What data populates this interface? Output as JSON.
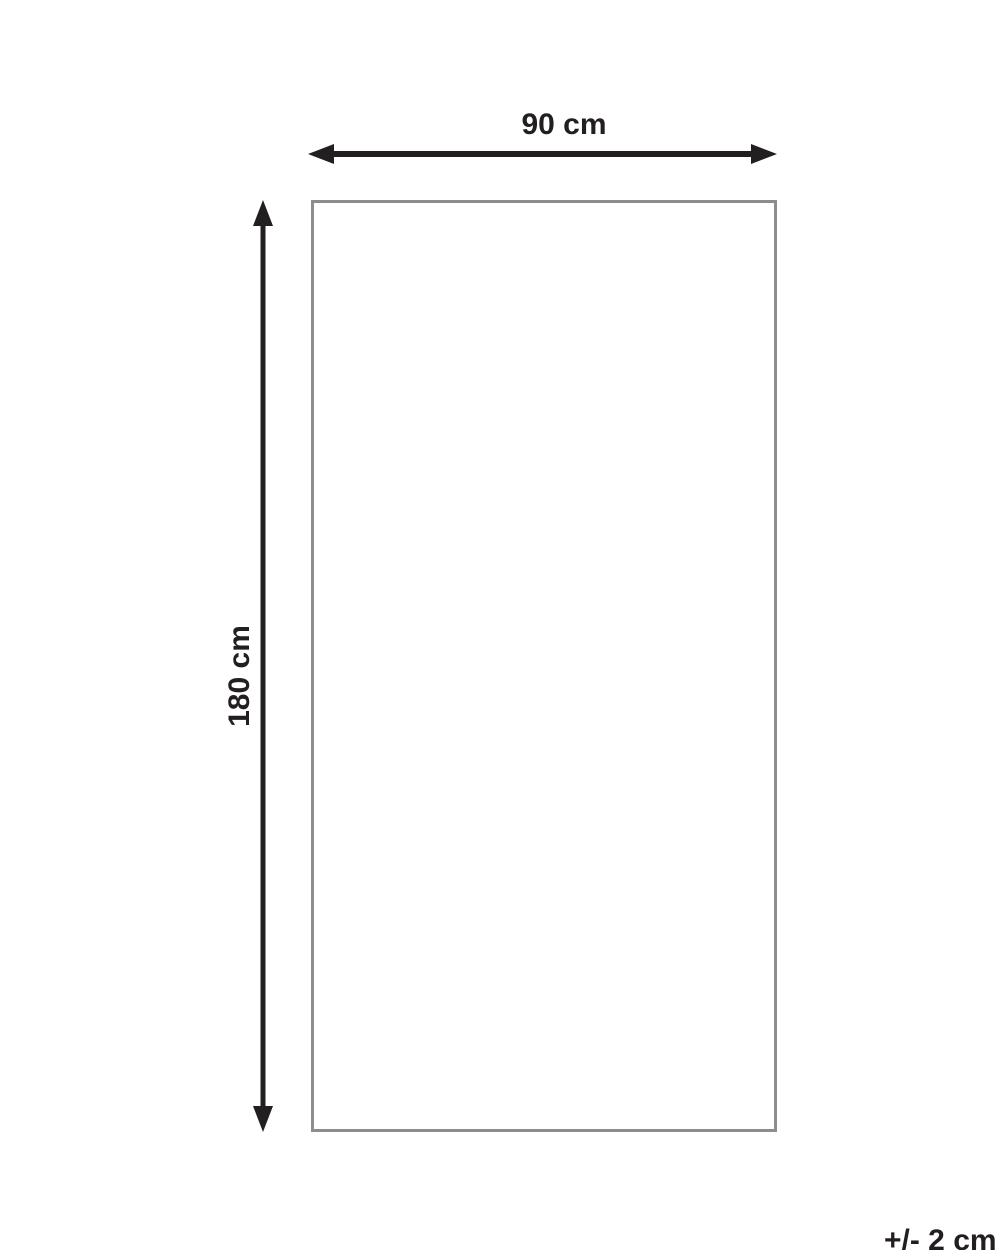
{
  "diagram": {
    "width_label": "90 cm",
    "height_label": "180 cm",
    "tolerance_label": "+/- 2 cm"
  },
  "colors": {
    "ink": "#231f20",
    "rectangle_border": "#8d8d8d",
    "background": "#ffffff"
  }
}
